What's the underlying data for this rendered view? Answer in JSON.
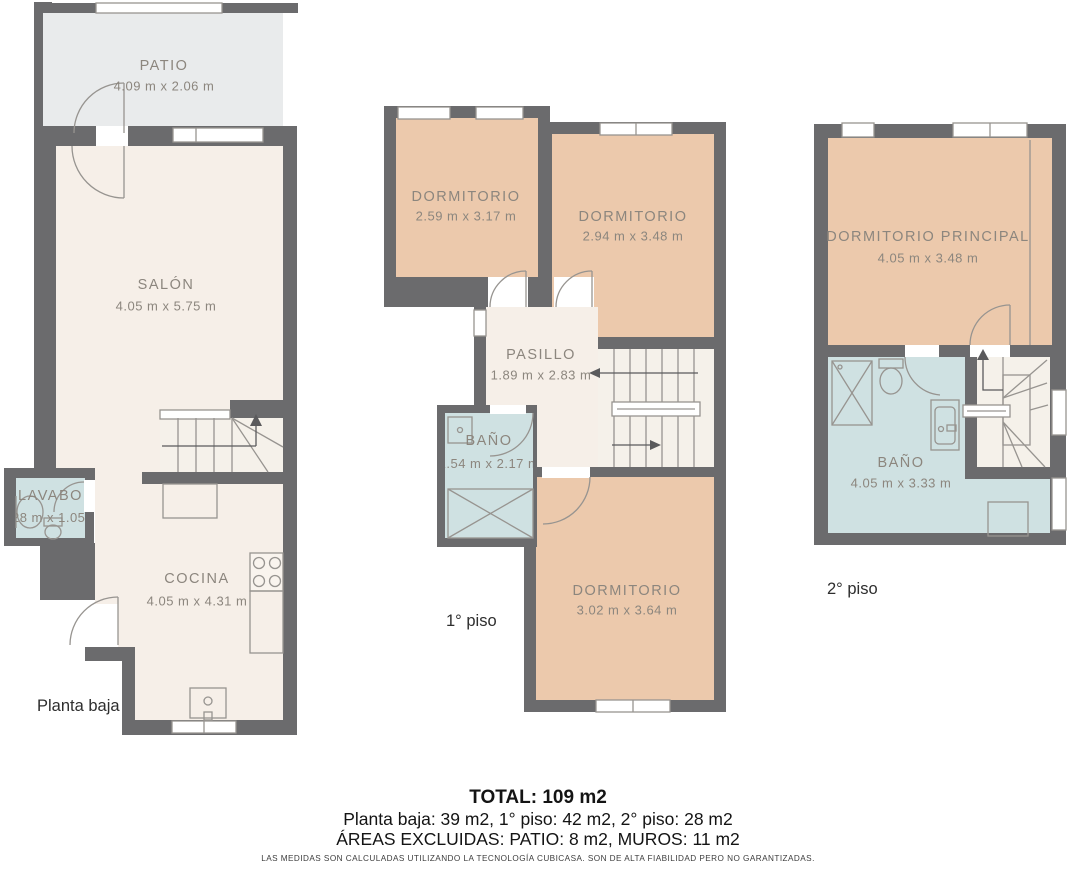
{
  "colors": {
    "wall": "#6b6b6d",
    "room": "#f6efe8",
    "stairs": "#f5f1ea",
    "bedroom": "#ecc9ac",
    "bath": "#cfe1e2",
    "patio": "#e9ebec",
    "label": "#8c867e",
    "ink": "#141414"
  },
  "floors": [
    {
      "label": "Planta baja",
      "rooms": [
        {
          "name": "PATIO",
          "dims": "4.09 m x 2.06 m"
        },
        {
          "name": "SALÓN",
          "dims": "4.05 m x 5.75 m"
        },
        {
          "name": "LAVABO",
          "dims": "1.28 m x 1.05 m"
        },
        {
          "name": "COCINA",
          "dims": "4.05 m x 4.31 m"
        }
      ]
    },
    {
      "label": "1° piso",
      "rooms": [
        {
          "name": "DORMITORIO",
          "dims": "2.59 m x 3.17 m"
        },
        {
          "name": "DORMITORIO",
          "dims": "2.94 m x 3.48 m"
        },
        {
          "name": "PASILLO",
          "dims": "1.89 m x 2.83 m"
        },
        {
          "name": "BAÑO",
          "dims": "1.54 m x 2.17 m"
        },
        {
          "name": "DORMITORIO",
          "dims": "3.02 m x 3.64 m"
        }
      ]
    },
    {
      "label": "2° piso",
      "rooms": [
        {
          "name": "DORMITORIO PRINCIPAL",
          "dims": "4.05 m x 3.48 m"
        },
        {
          "name": "BAÑO",
          "dims": "4.05 m x 3.33 m"
        }
      ]
    }
  ],
  "summary": {
    "total": "TOTAL: 109 m2",
    "per_floor": "Planta baja: 39 m2, 1° piso: 42 m2, 2° piso: 28 m2",
    "excluded": "ÁREAS EXCLUIDAS: PATIO: 8 m2, MUROS: 11 m2"
  },
  "disclaimer": "LAS MEDIDAS SON CALCULADAS UTILIZANDO LA TECNOLOGÍA CUBICASA. SON DE ALTA FIABILIDAD PERO NO GARANTIZADAS."
}
